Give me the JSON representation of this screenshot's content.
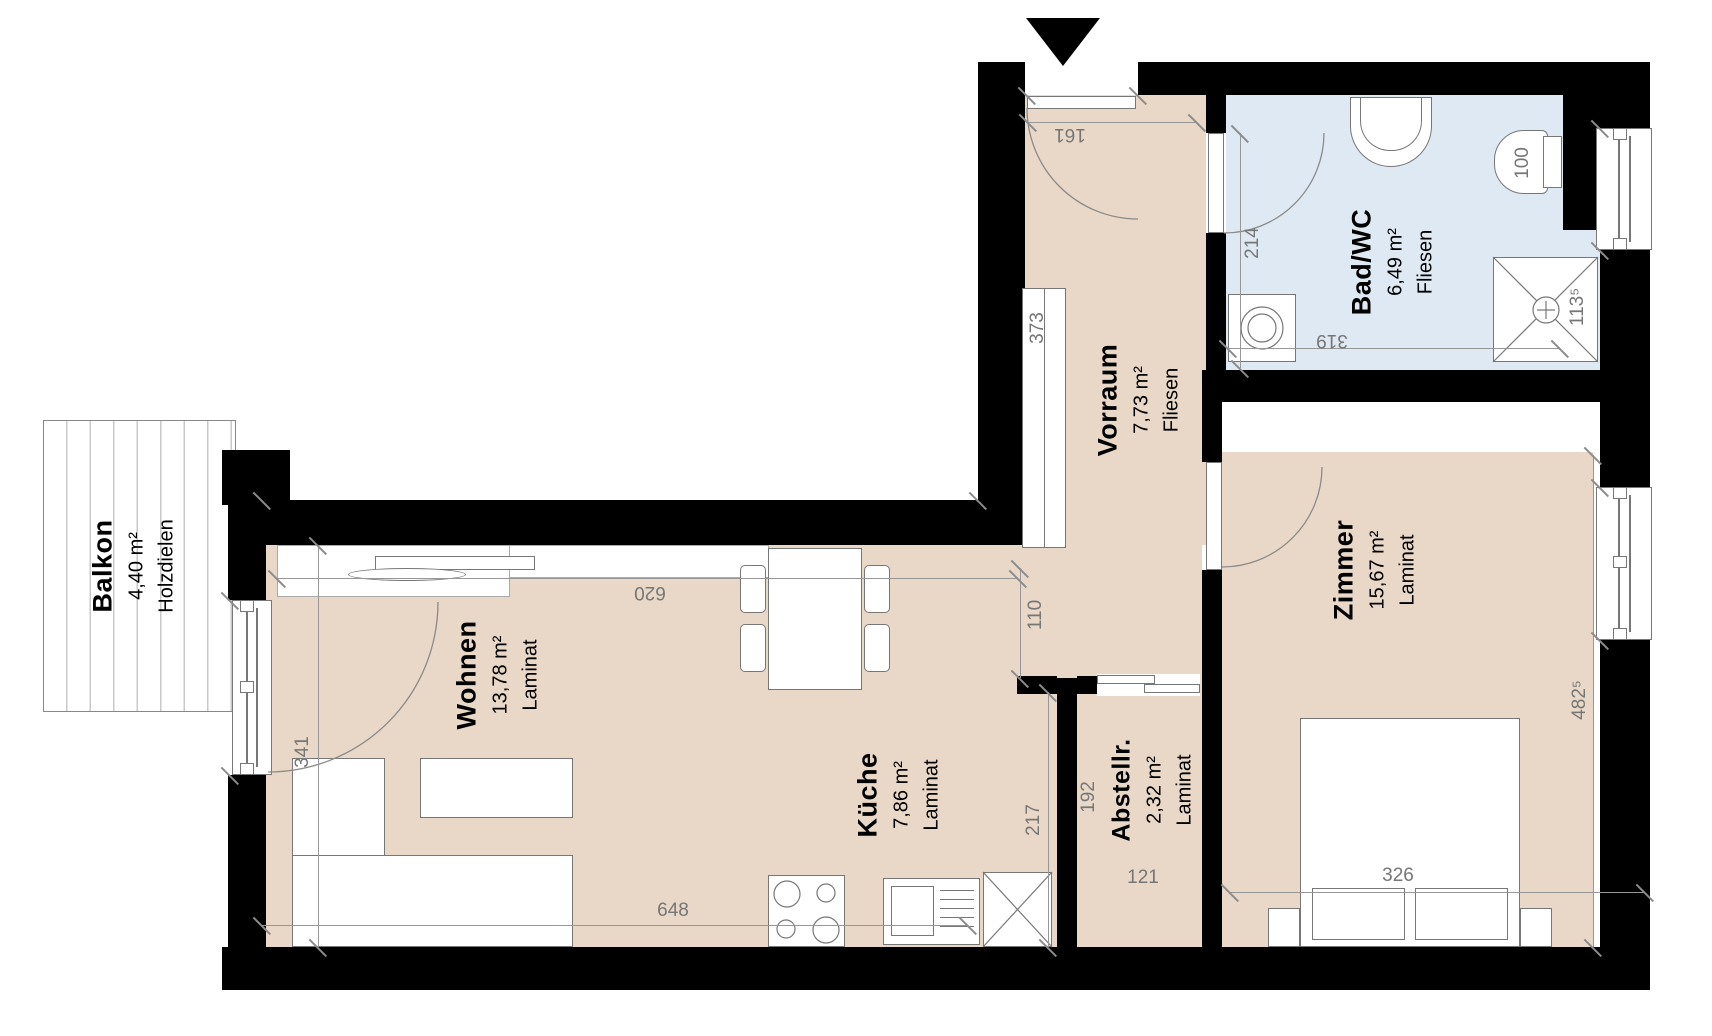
{
  "rooms": {
    "balkon": {
      "name": "Balkon",
      "area": "4,40 m²",
      "floor": "Holzdielen"
    },
    "wohnen": {
      "name": "Wohnen",
      "area": "13,78 m²",
      "floor": "Laminat"
    },
    "kueche": {
      "name": "Küche",
      "area": "7,86 m²",
      "floor": "Laminat"
    },
    "vorraum": {
      "name": "Vorraum",
      "area": "7,73 m²",
      "floor": "Fliesen"
    },
    "bad": {
      "name": "Bad/WC",
      "area": "6,49 m²",
      "floor": "Fliesen"
    },
    "zimmer": {
      "name": "Zimmer",
      "area": "15,67 m²",
      "floor": "Laminat"
    },
    "abstellraum": {
      "name": "Abstellr.",
      "area": "2,32 m²",
      "floor": "Laminat"
    }
  },
  "dims": {
    "d161": "161",
    "d373": "373",
    "d110": "110",
    "d620": "620",
    "d341": "341",
    "d648": "648",
    "d217": "217",
    "d192": "192",
    "d121": "121",
    "d326": "326",
    "d4825": "482⁵",
    "d214": "214",
    "d319": "319",
    "d100": "100",
    "d1135": "113⁵"
  },
  "colors": {
    "wall": "#000000",
    "floor_main": "#e9d8c7",
    "floor_bath": "#dfe9f3",
    "outline": "#777777",
    "dimension_text": "#767676"
  }
}
